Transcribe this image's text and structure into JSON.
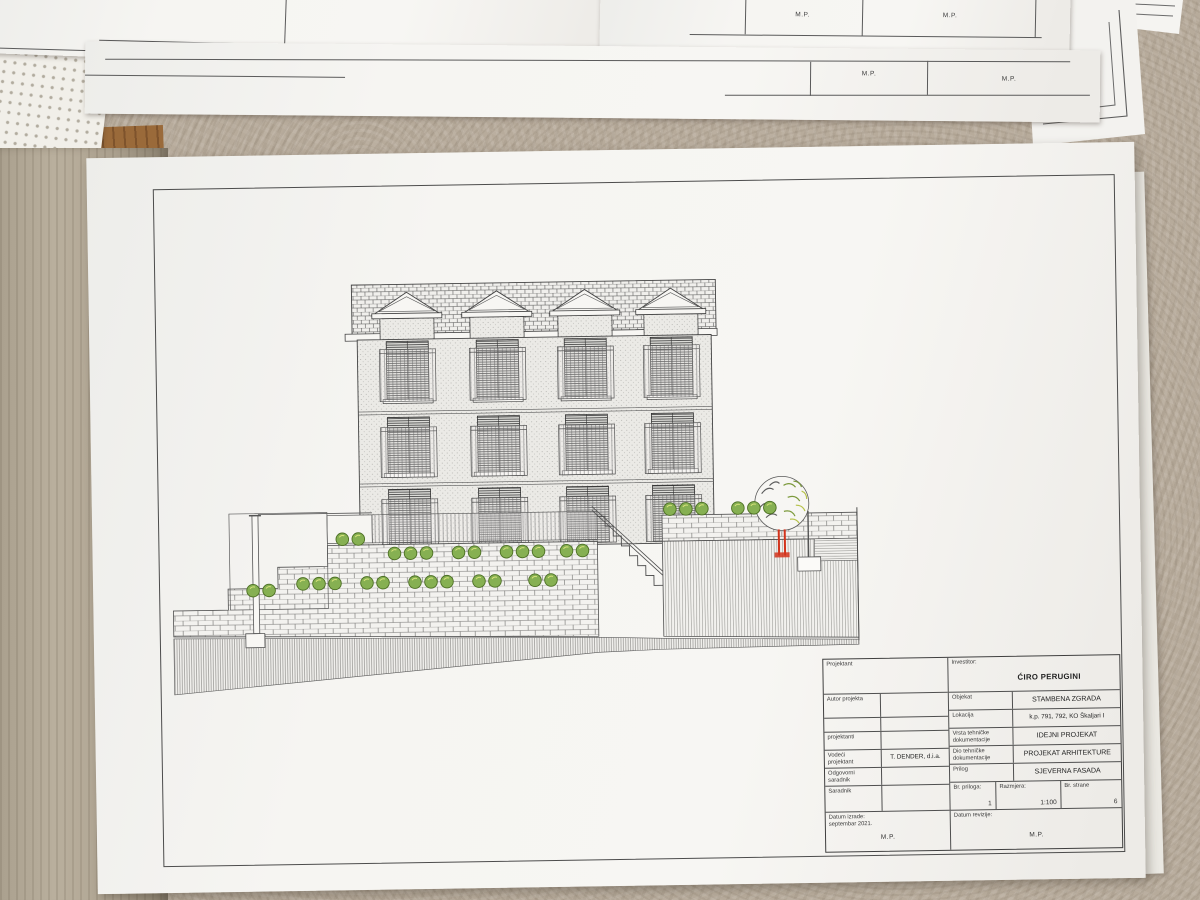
{
  "stamps": {
    "mp": "M.P."
  },
  "title_block": {
    "left": {
      "projektant": "Projektant",
      "autor": "Autor projekta",
      "projektanti": "projektanti",
      "vodeci_1": "Vodeći",
      "vodeci_2": "projektant",
      "vodeci_value": "T. DENDER, d.i.a.",
      "odgovorni_1": "Odgovorni",
      "odgovorni_2": "saradnik",
      "saradnik": "Saradnik",
      "datum_izrade_1": "Datum izrade:",
      "datum_izrade_2": "septembar 2021.",
      "mp": "M.P."
    },
    "right": {
      "investitor_label": "Investitor:",
      "investitor_value": "ĆIRO PERUGINI",
      "objekat_label": "Objekat",
      "objekat_value": "STAMBENA ZGRADA",
      "lokacija_label": "Lokacija",
      "lokacija_value": "k.p. 791, 792, KO Škaljari I",
      "vrsta_label_1": "Vrsta tehničke",
      "vrsta_label_2": "dokumentacije",
      "vrsta_value": "IDEJNI PROJEKAT",
      "dio_label_1": "Dio tehničke",
      "dio_label_2": "dokumentacije",
      "dio_value": "PROJEKAT ARHITEKTURE",
      "prilog_label": "Prilog",
      "prilog_value": "SJEVERNA FASADA",
      "br_priloga_label": "Br. priloga:",
      "br_priloga_value": "1",
      "razmjera_label": "Razmjera:",
      "razmjera_value": "1:100",
      "br_strane_label": "Br. strane",
      "br_strane_value": "6",
      "datum_revizije_label": "Datum revizije:",
      "mp": "M.P."
    }
  }
}
